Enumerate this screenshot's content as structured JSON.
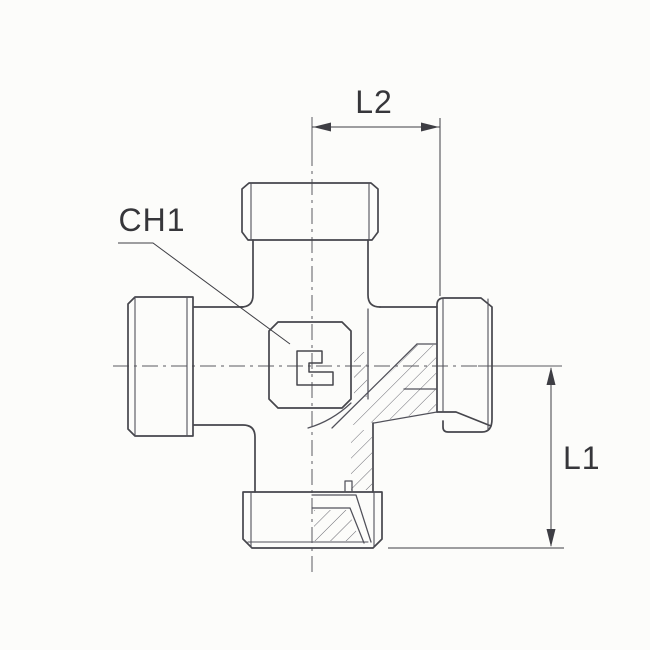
{
  "drawing": {
    "labels": {
      "l2": "L2",
      "ch1": "CH1",
      "l1": "L1"
    },
    "colors": {
      "background": "#fcfcfa",
      "outline": "#46464c",
      "detail": "#51515a",
      "centerline": "#5a5a60",
      "hatch": "#5a5a63",
      "dimension": "#3e3e44",
      "text": "#36363a"
    }
  }
}
